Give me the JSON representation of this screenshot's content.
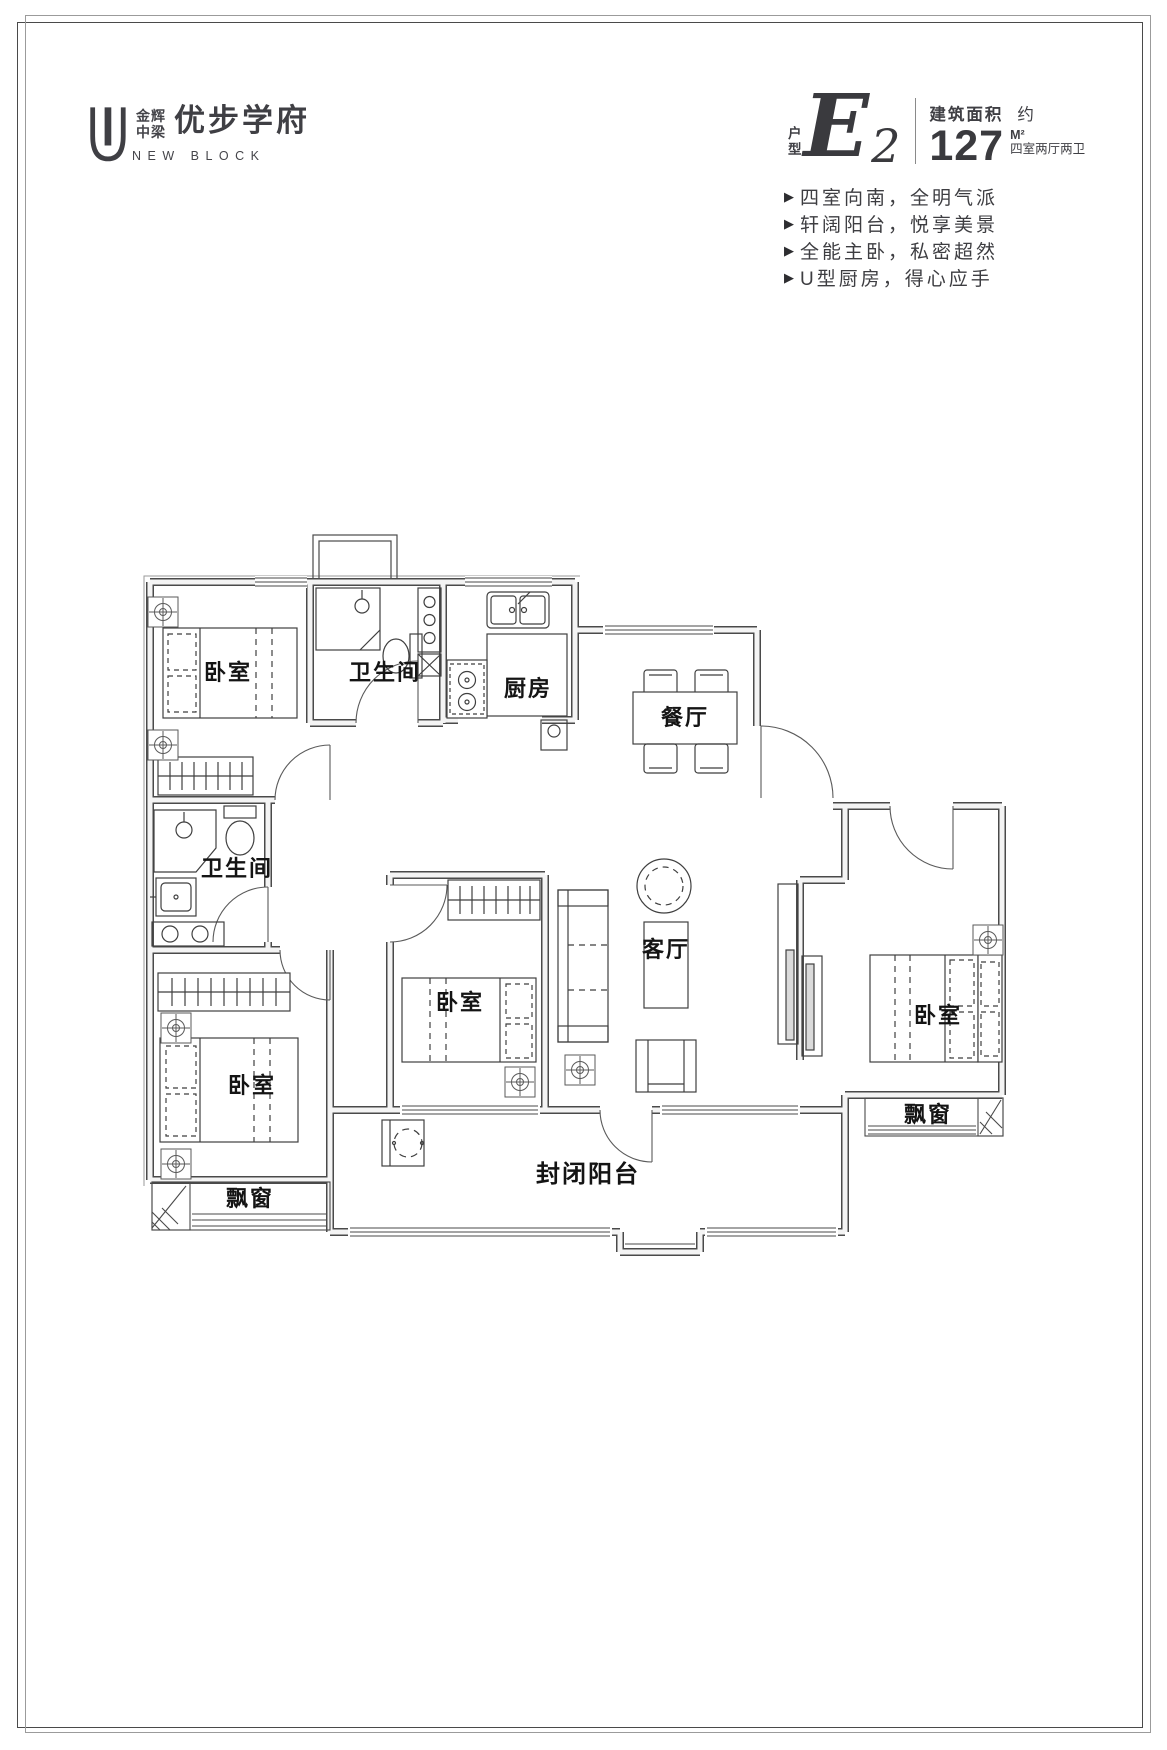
{
  "page": {
    "background": "#ffffff",
    "frame_dark": "#4a4a4a",
    "frame_gray": "#9b9b9b",
    "accent": "#3f3f44"
  },
  "logo": {
    "brand_line1": "金辉",
    "brand_line2": "中梁",
    "name": "优步学府",
    "subtitle": "NEW BLOCK"
  },
  "header": {
    "unit_prefix_line1": "户",
    "unit_prefix_line2": "型",
    "unit_letter": "E",
    "unit_number": "2",
    "area_label": "建筑面积",
    "area_approx": "约",
    "area_value": "127",
    "area_unit": "M²",
    "layout_summary": "四室两厅两卫"
  },
  "feature_marker": "▶",
  "features": [
    {
      "text": "四室向南，全明气派"
    },
    {
      "text": "轩阔阳台，悦享美景"
    },
    {
      "text": "全能主卧，私密超然"
    },
    {
      "text": "U型厨房，得心应手"
    }
  ],
  "floorplan": {
    "rooms": [
      {
        "id": "bedroom-top-left",
        "label": "卧室"
      },
      {
        "id": "bathroom-top",
        "label": "卫生间"
      },
      {
        "id": "kitchen",
        "label": "厨房"
      },
      {
        "id": "dining-room",
        "label": "餐厅"
      },
      {
        "id": "bathroom-middle",
        "label": "卫生间"
      },
      {
        "id": "living-room",
        "label": "客厅"
      },
      {
        "id": "bedroom-middle",
        "label": "卧室"
      },
      {
        "id": "bedroom-right",
        "label": "卧室"
      },
      {
        "id": "bedroom-bottom-left",
        "label": "卧室"
      },
      {
        "id": "bay-window-left",
        "label": "飘窗"
      },
      {
        "id": "balcony",
        "label": "封闭阳台"
      },
      {
        "id": "bay-window-right",
        "label": "飘窗"
      }
    ]
  }
}
